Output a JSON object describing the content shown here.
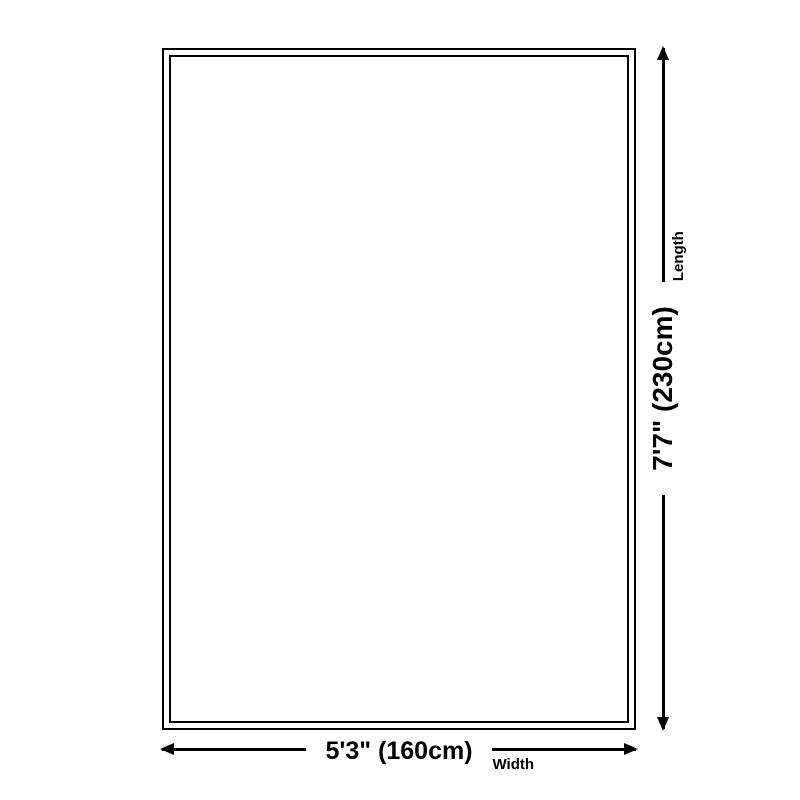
{
  "diagram": {
    "background_color": "#ffffff",
    "line_color": "#000000",
    "width_dimension": {
      "value": "5'3\" (160cm)",
      "label": "Width"
    },
    "length_dimension": {
      "value": "7'7\" (230cm)",
      "label": "Length"
    }
  }
}
